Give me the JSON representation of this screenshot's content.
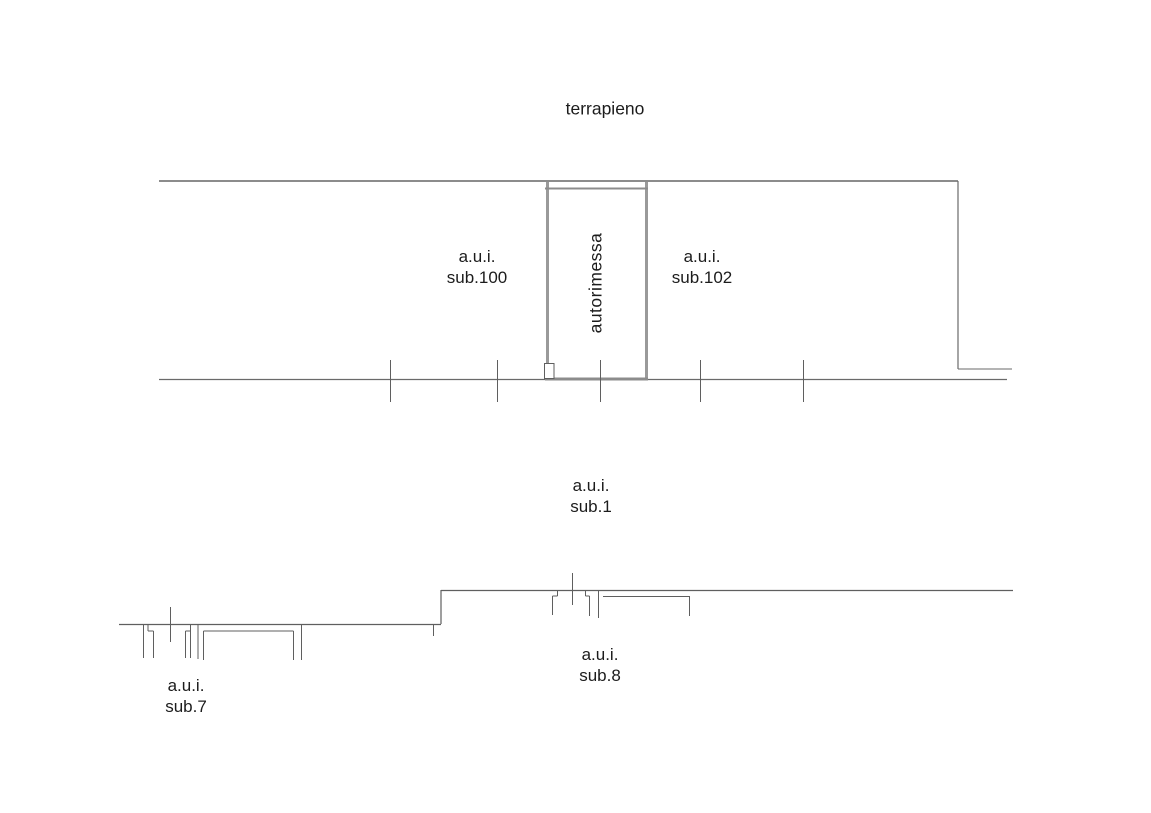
{
  "texts": {
    "terrapieno": "terrapieno",
    "autorimessa": "autorimessa",
    "sub100": {
      "line1": "a.u.i.",
      "line2": "sub.100"
    },
    "sub102": {
      "line1": "a.u.i.",
      "line2": "sub.102"
    },
    "sub1": {
      "line1": "a.u.i.",
      "line2": "sub.1"
    },
    "sub8": {
      "line1": "a.u.i.",
      "line2": "sub.8"
    },
    "sub7": {
      "line1": "a.u.i.",
      "line2": "sub.7"
    }
  },
  "colors": {
    "background": "#ffffff",
    "text": "#1c1c1c",
    "line_thin": "#5f5f5f",
    "line_medium": "#8c8c8c",
    "line_thick": "#9a9a9a"
  },
  "drawing": {
    "width": 1151,
    "height": 813,
    "segments": [
      {
        "name": "upper-top-wall",
        "x1": 159,
        "y1": 181,
        "x2": 958,
        "y2": 181,
        "w": 2,
        "c": "#8c8c8c"
      },
      {
        "name": "upper-right-wall",
        "x1": 958,
        "y1": 181,
        "x2": 958,
        "y2": 369,
        "w": 1.2,
        "c": "#6a6a6a"
      },
      {
        "name": "upper-right-jog",
        "x1": 958,
        "y1": 369,
        "x2": 1012,
        "y2": 369,
        "w": 1,
        "c": "#6a6a6a"
      },
      {
        "name": "upper-ground-line",
        "x1": 159,
        "y1": 379.5,
        "x2": 1007,
        "y2": 379.5,
        "w": 1.2,
        "c": "#6a6a6a"
      },
      {
        "name": "garage-left-wall",
        "x1": 547.5,
        "y1": 182,
        "x2": 547.5,
        "y2": 378,
        "w": 3,
        "c": "#9a9a9a"
      },
      {
        "name": "garage-right-wall",
        "x1": 646.5,
        "y1": 182,
        "x2": 646.5,
        "y2": 378,
        "w": 3,
        "c": "#9a9a9a"
      },
      {
        "name": "garage-top-wall",
        "x1": 545,
        "y1": 188.5,
        "x2": 648,
        "y2": 188.5,
        "w": 2,
        "c": "#8c8c8c"
      },
      {
        "name": "garage-bottom-wall",
        "x1": 545,
        "y1": 379,
        "x2": 648,
        "y2": 379,
        "w": 3,
        "c": "#8c8c8c"
      },
      {
        "name": "upper-tick-1",
        "x1": 390.5,
        "y1": 360,
        "x2": 390.5,
        "y2": 402,
        "w": 1,
        "c": "#5f5f5f"
      },
      {
        "name": "upper-tick-2",
        "x1": 497.5,
        "y1": 360,
        "x2": 497.5,
        "y2": 402,
        "w": 1,
        "c": "#5f5f5f"
      },
      {
        "name": "upper-tick-3",
        "x1": 600.5,
        "y1": 360,
        "x2": 600.5,
        "y2": 402,
        "w": 1,
        "c": "#5f5f5f"
      },
      {
        "name": "upper-tick-4",
        "x1": 700.5,
        "y1": 360,
        "x2": 700.5,
        "y2": 402,
        "w": 1,
        "c": "#5f5f5f"
      },
      {
        "name": "upper-tick-5",
        "x1": 803.5,
        "y1": 360,
        "x2": 803.5,
        "y2": 402,
        "w": 1,
        "c": "#5f5f5f"
      },
      {
        "name": "lower-line-left",
        "x1": 119,
        "y1": 624.5,
        "x2": 441,
        "y2": 624.5,
        "w": 1.2,
        "c": "#5f5f5f"
      },
      {
        "name": "lower-step-stub",
        "x1": 433.5,
        "y1": 624,
        "x2": 433.5,
        "y2": 636,
        "w": 1,
        "c": "#5f5f5f"
      },
      {
        "name": "lower-step-riser",
        "x1": 441,
        "y1": 590,
        "x2": 441,
        "y2": 624,
        "w": 1.2,
        "c": "#5f5f5f"
      },
      {
        "name": "lower-line-right",
        "x1": 441,
        "y1": 590.5,
        "x2": 1013,
        "y2": 590.5,
        "w": 1.2,
        "c": "#5f5f5f"
      },
      {
        "name": "sub7-opening1-left",
        "x1": 143.5,
        "y1": 624,
        "x2": 143.5,
        "y2": 658,
        "w": 1,
        "c": "#5f5f5f"
      },
      {
        "name": "sub7-opening1-stub",
        "x1": 148,
        "y1": 624,
        "x2": 148,
        "y2": 631,
        "w": 1,
        "c": "#5f5f5f"
      },
      {
        "name": "sub7-opening1-jog",
        "x1": 148,
        "y1": 631,
        "x2": 153.5,
        "y2": 631,
        "w": 1,
        "c": "#5f5f5f"
      },
      {
        "name": "sub7-opening1-right",
        "x1": 153.5,
        "y1": 631,
        "x2": 153.5,
        "y2": 658,
        "w": 1,
        "c": "#5f5f5f"
      },
      {
        "name": "sub7-tick",
        "x1": 170.5,
        "y1": 607,
        "x2": 170.5,
        "y2": 642,
        "w": 1,
        "c": "#5f5f5f"
      },
      {
        "name": "sub7-opening2-left",
        "x1": 185.5,
        "y1": 631,
        "x2": 185.5,
        "y2": 658,
        "w": 1,
        "c": "#5f5f5f"
      },
      {
        "name": "sub7-opening2-jog",
        "x1": 185.5,
        "y1": 631,
        "x2": 190.5,
        "y2": 631,
        "w": 1,
        "c": "#5f5f5f"
      },
      {
        "name": "sub7-opening2-right",
        "x1": 190.5,
        "y1": 624,
        "x2": 190.5,
        "y2": 658,
        "w": 1,
        "c": "#5f5f5f"
      },
      {
        "name": "sub7-wall-post",
        "x1": 198,
        "y1": 624,
        "x2": 198,
        "y2": 659,
        "w": 1,
        "c": "#5f5f5f"
      },
      {
        "name": "sub7-recess-left",
        "x1": 203.5,
        "y1": 631,
        "x2": 203.5,
        "y2": 660,
        "w": 1,
        "c": "#5f5f5f"
      },
      {
        "name": "sub7-recess-top",
        "x1": 203.5,
        "y1": 631,
        "x2": 293.5,
        "y2": 631,
        "w": 1,
        "c": "#5f5f5f"
      },
      {
        "name": "sub7-recess-right",
        "x1": 293.5,
        "y1": 631,
        "x2": 293.5,
        "y2": 660,
        "w": 1,
        "c": "#5f5f5f"
      },
      {
        "name": "sub7-end-post",
        "x1": 301.5,
        "y1": 624,
        "x2": 301.5,
        "y2": 660,
        "w": 1,
        "c": "#5f5f5f"
      },
      {
        "name": "sub8-opening1-left",
        "x1": 552.5,
        "y1": 596,
        "x2": 552.5,
        "y2": 615,
        "w": 1,
        "c": "#5f5f5f"
      },
      {
        "name": "sub8-opening1-jog",
        "x1": 552.5,
        "y1": 596,
        "x2": 557.5,
        "y2": 596,
        "w": 1,
        "c": "#5f5f5f"
      },
      {
        "name": "sub8-opening1-stub",
        "x1": 557.5,
        "y1": 590,
        "x2": 557.5,
        "y2": 596,
        "w": 1,
        "c": "#5f5f5f"
      },
      {
        "name": "sub8-tick",
        "x1": 572.5,
        "y1": 573,
        "x2": 572.5,
        "y2": 605,
        "w": 1,
        "c": "#5f5f5f"
      },
      {
        "name": "sub8-opening2-stub",
        "x1": 585.5,
        "y1": 590,
        "x2": 585.5,
        "y2": 596,
        "w": 1,
        "c": "#5f5f5f"
      },
      {
        "name": "sub8-opening2-jog",
        "x1": 585.5,
        "y1": 596,
        "x2": 589.5,
        "y2": 596,
        "w": 1,
        "c": "#5f5f5f"
      },
      {
        "name": "sub8-opening2-right",
        "x1": 589.5,
        "y1": 596,
        "x2": 589.5,
        "y2": 616,
        "w": 1,
        "c": "#5f5f5f"
      },
      {
        "name": "sub8-wall-post",
        "x1": 598.5,
        "y1": 590,
        "x2": 598.5,
        "y2": 618,
        "w": 1,
        "c": "#5f5f5f"
      },
      {
        "name": "sub8-recess-top",
        "x1": 603,
        "y1": 596.5,
        "x2": 689,
        "y2": 596.5,
        "w": 1,
        "c": "#5f5f5f"
      },
      {
        "name": "sub8-recess-right",
        "x1": 689.5,
        "y1": 596,
        "x2": 689.5,
        "y2": 616,
        "w": 1,
        "c": "#5f5f5f"
      }
    ],
    "rects": [
      {
        "name": "garage-door-notch",
        "x": 544.5,
        "y": 363.5,
        "w": 9.5,
        "h": 15,
        "fill": "#ffffff",
        "stroke": "#5f5f5f",
        "sw": 1
      }
    ]
  }
}
